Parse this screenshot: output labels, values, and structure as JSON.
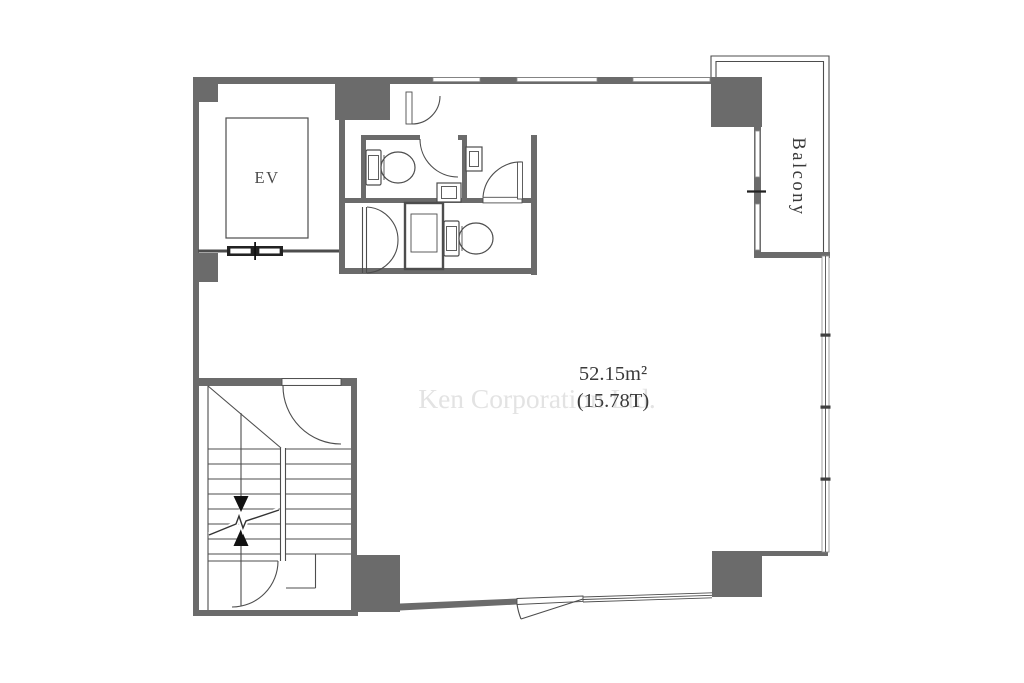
{
  "floor_plan": {
    "labels": {
      "elevator": "EV",
      "balcony": "Balcony",
      "area_sqm": "52.15m²",
      "area_tsubo": "(15.78T)",
      "watermark": "Ken Corporation Ltd."
    },
    "colors": {
      "wall": "#6b6b6b",
      "line": "#4d4d4d",
      "dark": "#222222",
      "text": "#3a3a3a",
      "label": "#4a4a4a",
      "watermark": "#e3e3e3",
      "arrow": "#111111",
      "background": "#ffffff"
    }
  }
}
